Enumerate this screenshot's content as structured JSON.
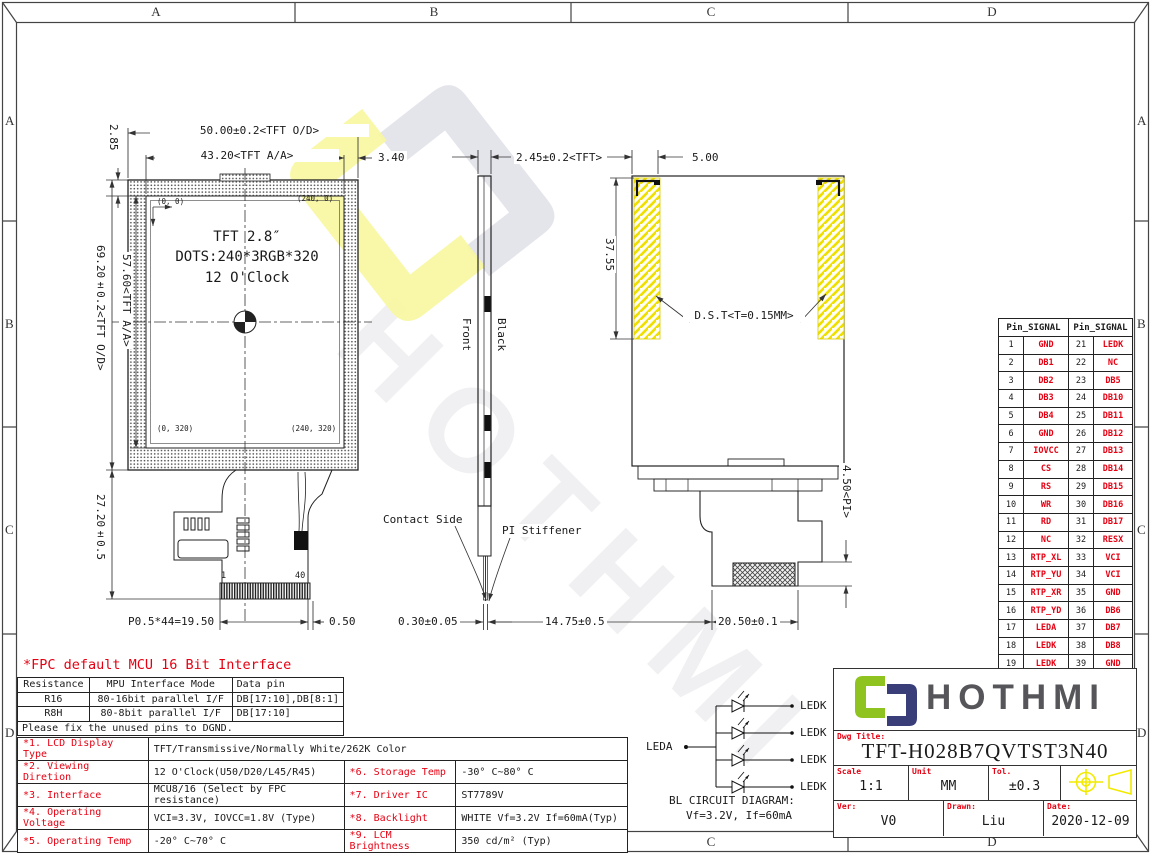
{
  "zones": {
    "top": [
      "A",
      "B",
      "C",
      "D"
    ],
    "bottom": [
      "A",
      "B",
      "C",
      "D"
    ],
    "left": [
      "A",
      "B",
      "C",
      "D"
    ],
    "right": [
      "A",
      "B",
      "C",
      "D"
    ]
  },
  "front_view": {
    "dim_od_width": "50.00±0.2<TFT O/D>",
    "dim_aa_width": "43.20<TFT A/A>",
    "dim_side_margin": "3.40",
    "dim_top_margin": "2.85",
    "dim_od_height": "69.20±0.2<TFT O/D>",
    "dim_aa_height": "57.60<TFT A/A>",
    "dim_tail_length": "27.20±0.5",
    "dim_pin_pitch": "P0.5*44=19.50",
    "dim_pin_offset": "0.50",
    "coord_tl": "(0, 0)",
    "coord_tr": "(240, 0)",
    "coord_bl": "(0, 320)",
    "coord_br": "(240, 320)",
    "panel_line1": "TFT 2.8″",
    "panel_line2": "DOTS:240*3RGB*320",
    "panel_line3": "12 O'Clock",
    "pin_first": "1",
    "pin_last": "40"
  },
  "side_view": {
    "dim_thickness": "2.45±0.2<TFT>",
    "label_front": "Front",
    "label_black": "Black",
    "label_contact": "Contact Side",
    "label_stiffener": "PI Stiffener",
    "dim_fpc_thickness": "0.30±0.05"
  },
  "back_view": {
    "dim_tape_width": "5.00",
    "dim_tape_height": "37.55",
    "label_tape": "D.S.T<T=0.15MM>",
    "dim_pi": "4.50<PI>",
    "dim_connector": "20.50±0.1",
    "dim_offset": "14.75±0.5"
  },
  "pin_table": {
    "header_left": "Pin_SIGNAL",
    "header_right": "Pin_SIGNAL",
    "rows": [
      [
        "1",
        "GND",
        "21",
        "LEDK"
      ],
      [
        "2",
        "DB1",
        "22",
        "NC"
      ],
      [
        "3",
        "DB2",
        "23",
        "DB5"
      ],
      [
        "4",
        "DB3",
        "24",
        "DB10"
      ],
      [
        "5",
        "DB4",
        "25",
        "DB11"
      ],
      [
        "6",
        "GND",
        "26",
        "DB12"
      ],
      [
        "7",
        "IOVCC",
        "27",
        "DB13"
      ],
      [
        "8",
        "CS",
        "28",
        "DB14"
      ],
      [
        "9",
        "RS",
        "29",
        "DB15"
      ],
      [
        "10",
        "WR",
        "30",
        "DB16"
      ],
      [
        "11",
        "RD",
        "31",
        "DB17"
      ],
      [
        "12",
        "NC",
        "32",
        "RESX"
      ],
      [
        "13",
        "RTP_XL",
        "33",
        "VCI"
      ],
      [
        "14",
        "RTP_YU",
        "34",
        "VCI"
      ],
      [
        "15",
        "RTP_XR",
        "35",
        "GND"
      ],
      [
        "16",
        "RTP_YD",
        "36",
        "DB6"
      ],
      [
        "17",
        "LEDA",
        "37",
        "DB7"
      ],
      [
        "18",
        "LEDK",
        "38",
        "DB8"
      ],
      [
        "19",
        "LEDK",
        "39",
        "GND"
      ],
      [
        "20",
        "LEDK",
        "40",
        "GND"
      ]
    ]
  },
  "fpc_note": "*FPC default MCU 16 Bit Interface",
  "resistance_table": {
    "headers": [
      "Resistance",
      "MPU Interface Mode",
      "Data pin"
    ],
    "rows": [
      [
        "R16",
        "80-16bit parallel I/F",
        "DB[17:10],DB[8:1]"
      ],
      [
        "R8H",
        "80-8bit parallel I/F",
        "DB[17:10]"
      ]
    ],
    "note": "Please fix the unused pins to DGND."
  },
  "spec_table": {
    "row1_label": "*1. LCD Display Type",
    "row1_value": "TFT/Transmissive/Normally White/262K Color",
    "rows": [
      {
        "l": "*2. Viewing Diretion",
        "lv": "12 O'Clock(U50/D20/L45/R45)",
        "r": "*6. Storage Temp",
        "rv": "-30° C~80° C"
      },
      {
        "l": "*3. Interface",
        "lv": "MCU8/16 (Select by FPC resistance)",
        "r": "*7. Driver IC",
        "rv": "ST7789V"
      },
      {
        "l": "*4. Operating Voltage",
        "lv": "VCI=3.3V, IOVCC=1.8V (Type)",
        "r": "*8. Backlight",
        "rv": "WHITE Vf=3.2V If=60mA(Typ)"
      },
      {
        "l": "*5. Operating Temp",
        "lv": "-20° C~70° C",
        "r": "*9. LCM Brightness",
        "rv": "350 cd/m² (Typ)"
      }
    ]
  },
  "bl_circuit": {
    "leda": "LEDA",
    "ledk": "LEDK",
    "caption1": "BL CIRCUIT DIAGRAM:",
    "caption2": "Vf=3.2V, If=60mA"
  },
  "title_block": {
    "brand": "HOTHMI",
    "dwg_title_label": "Dwg Title:",
    "dwg_title": "TFT-H028B7QVTST3N40",
    "scale_label": "Scale",
    "scale": "1:1",
    "unit_label": "Unit",
    "unit": "MM",
    "tol_label": "Tol.",
    "tol": "±0.3",
    "ver_label": "Ver:",
    "ver": "V0",
    "drawn_label": "Drawn:",
    "drawn": "Liu",
    "date_label": "Date:",
    "date": "2020-12-09"
  },
  "watermark": {
    "text": "HOTHMI"
  },
  "colors": {
    "signal_red": "#e60012",
    "hatch_yellow": "#f0e000",
    "logo_green": "#8fc31f",
    "logo_navy": "#3a3e78",
    "brand_gray": "#56565a"
  }
}
